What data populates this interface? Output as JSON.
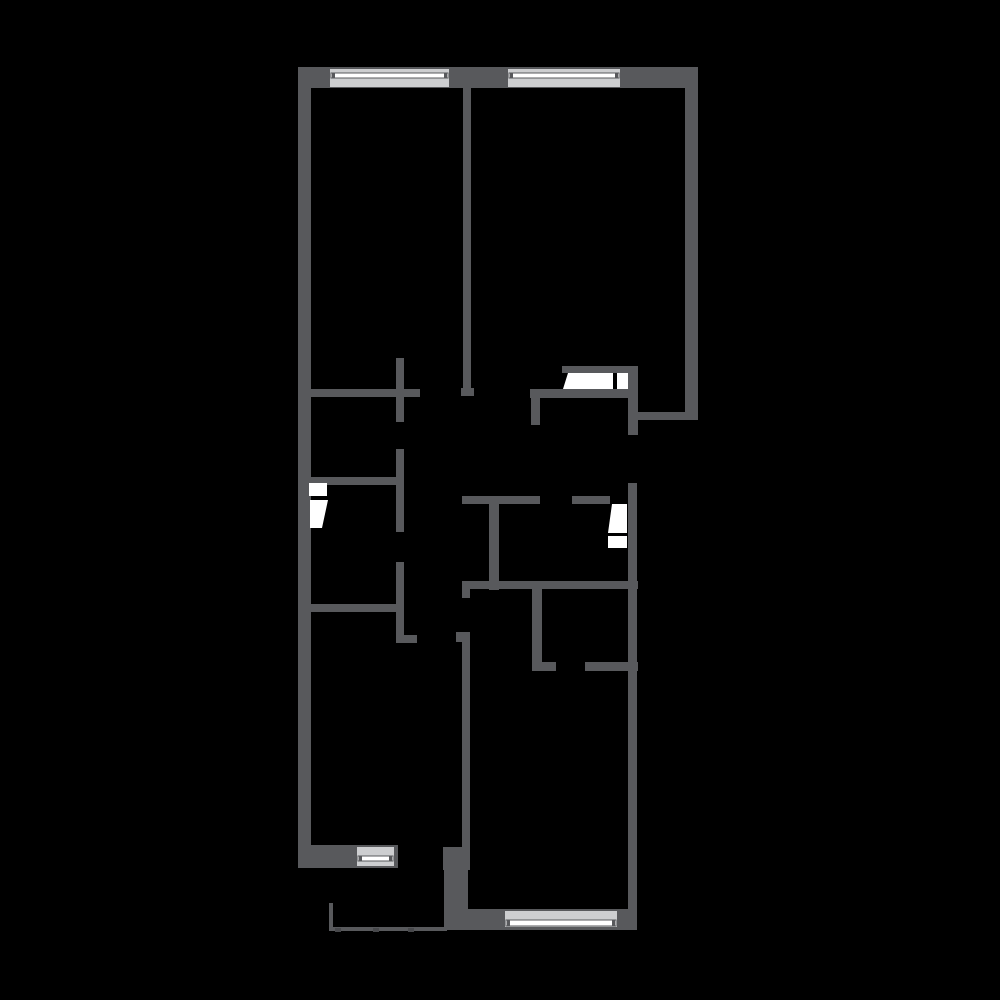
{
  "canvas": {
    "width": 1000,
    "height": 1000,
    "background": "#000000"
  },
  "plan": {
    "colors": {
      "wall": "#58595c",
      "window_base": "#cdced0",
      "window_stripe": "#ffffff",
      "window_frame": "#58595c",
      "door": "#ffffff",
      "rail": "#58595c",
      "rail_post": "#47484b"
    },
    "walls": [
      {
        "name": "exterior-left",
        "x": 298,
        "y": 67,
        "w": 13,
        "h": 801
      },
      {
        "name": "exterior-top",
        "x": 298,
        "y": 67,
        "w": 400,
        "h": 21
      },
      {
        "name": "exterior-right-upper",
        "x": 685,
        "y": 67,
        "w": 13,
        "h": 353
      },
      {
        "name": "divider-top-rooms",
        "x": 463,
        "y": 88,
        "w": 8,
        "h": 300
      },
      {
        "name": "divider-foot",
        "x": 461,
        "y": 388,
        "w": 13,
        "h": 8
      },
      {
        "name": "hall-top-left",
        "x": 308,
        "y": 389,
        "w": 112,
        "h": 8
      },
      {
        "name": "cross-vertical-upper",
        "x": 396,
        "y": 358,
        "w": 8,
        "h": 64
      },
      {
        "name": "closet-right-wall",
        "x": 396,
        "y": 449,
        "w": 8,
        "h": 83
      },
      {
        "name": "closet-right-wall-lower",
        "x": 396,
        "y": 562,
        "w": 8,
        "h": 81
      },
      {
        "name": "closet-right-foot",
        "x": 396,
        "y": 635,
        "w": 21,
        "h": 8
      },
      {
        "name": "closet-top",
        "x": 308,
        "y": 477,
        "w": 89,
        "h": 8
      },
      {
        "name": "left-room-top",
        "x": 308,
        "y": 604,
        "w": 89,
        "h": 8
      },
      {
        "name": "door-top-lintel",
        "x": 562,
        "y": 366,
        "w": 66,
        "h": 7
      },
      {
        "name": "niche-left",
        "x": 628,
        "y": 366,
        "w": 10,
        "h": 69
      },
      {
        "name": "niche-bottom",
        "x": 633,
        "y": 412,
        "w": 65,
        "h": 8
      },
      {
        "name": "hall-top-right",
        "x": 530,
        "y": 389,
        "w": 108,
        "h": 9
      },
      {
        "name": "hall-top-right-stub",
        "x": 531,
        "y": 398,
        "w": 9,
        "h": 27
      },
      {
        "name": "exterior-right-lower",
        "x": 628,
        "y": 483,
        "w": 9,
        "h": 445
      },
      {
        "name": "mid-horizontal-left",
        "x": 462,
        "y": 496,
        "w": 78,
        "h": 8
      },
      {
        "name": "mid-horizontal-right",
        "x": 572,
        "y": 496,
        "w": 38,
        "h": 8
      },
      {
        "name": "mid-vertical",
        "x": 489,
        "y": 504,
        "w": 10,
        "h": 86
      },
      {
        "name": "mid-horizontal-long",
        "x": 462,
        "y": 581,
        "w": 176,
        "h": 8
      },
      {
        "name": "mid-stub",
        "x": 462,
        "y": 589,
        "w": 8,
        "h": 9
      },
      {
        "name": "small-room-left-wall",
        "x": 532,
        "y": 589,
        "w": 10,
        "h": 82
      },
      {
        "name": "small-room-foot",
        "x": 532,
        "y": 662,
        "w": 24,
        "h": 9
      },
      {
        "name": "small-room-bottom-right",
        "x": 585,
        "y": 662,
        "w": 53,
        "h": 9
      },
      {
        "name": "corridor-wall",
        "x": 462,
        "y": 632,
        "w": 8,
        "h": 215
      },
      {
        "name": "corridor-wall-tab",
        "x": 456,
        "y": 632,
        "w": 14,
        "h": 10
      },
      {
        "name": "corner-block",
        "x": 443,
        "y": 847,
        "w": 27,
        "h": 23
      },
      {
        "name": "bottom-room-left-wall",
        "x": 444,
        "y": 870,
        "w": 24,
        "h": 60
      },
      {
        "name": "bottom-left-exterior",
        "x": 298,
        "y": 845,
        "w": 100,
        "h": 23
      },
      {
        "name": "bottom-right-exterior",
        "x": 444,
        "y": 909,
        "w": 193,
        "h": 21
      }
    ],
    "windows": [
      {
        "name": "window-top-left",
        "x": 330,
        "y": 69,
        "w": 119,
        "h": 18,
        "stripe_y": 73,
        "stripe_h": 5
      },
      {
        "name": "window-top-right",
        "x": 508,
        "y": 69,
        "w": 112,
        "h": 18,
        "stripe_y": 73,
        "stripe_h": 5
      },
      {
        "name": "window-bottom-left",
        "x": 357,
        "y": 847,
        "w": 37,
        "h": 19,
        "stripe_y": 856,
        "stripe_h": 5
      },
      {
        "name": "window-bottom-right",
        "x": 505,
        "y": 911,
        "w": 112,
        "h": 16,
        "stripe_y": 920,
        "stripe_h": 6
      }
    ],
    "doors": [
      {
        "name": "door-top-right-leaf",
        "points": "568,373 613,373 613,389 563,389"
      },
      {
        "name": "door-top-right-panel",
        "points": "617,373 628,373 628,389 617,389"
      },
      {
        "name": "door-right-leaf",
        "points": "612,504 627,504 627,533 608,533"
      },
      {
        "name": "door-right-panel",
        "points": "608,536 627,536 627,548 608,548"
      },
      {
        "name": "door-closet-panel",
        "points": "309,483 327,483 327,496 309,496"
      },
      {
        "name": "door-closet-leaf",
        "points": "310,500 328,500 322,528 310,528"
      }
    ],
    "rails": [
      {
        "name": "balcony-rail-left",
        "x": 329,
        "y": 903,
        "w": 4,
        "h": 28
      },
      {
        "name": "balcony-rail-bottom",
        "x": 329,
        "y": 927,
        "w": 118,
        "h": 4
      }
    ],
    "rail_posts": [
      {
        "name": "balcony-rail-post-1",
        "x": 335,
        "y": 928,
        "w": 6,
        "h": 4
      },
      {
        "name": "balcony-rail-post-2",
        "x": 373,
        "y": 928,
        "w": 6,
        "h": 4
      },
      {
        "name": "balcony-rail-post-3",
        "x": 408,
        "y": 928,
        "w": 6,
        "h": 4
      }
    ]
  }
}
